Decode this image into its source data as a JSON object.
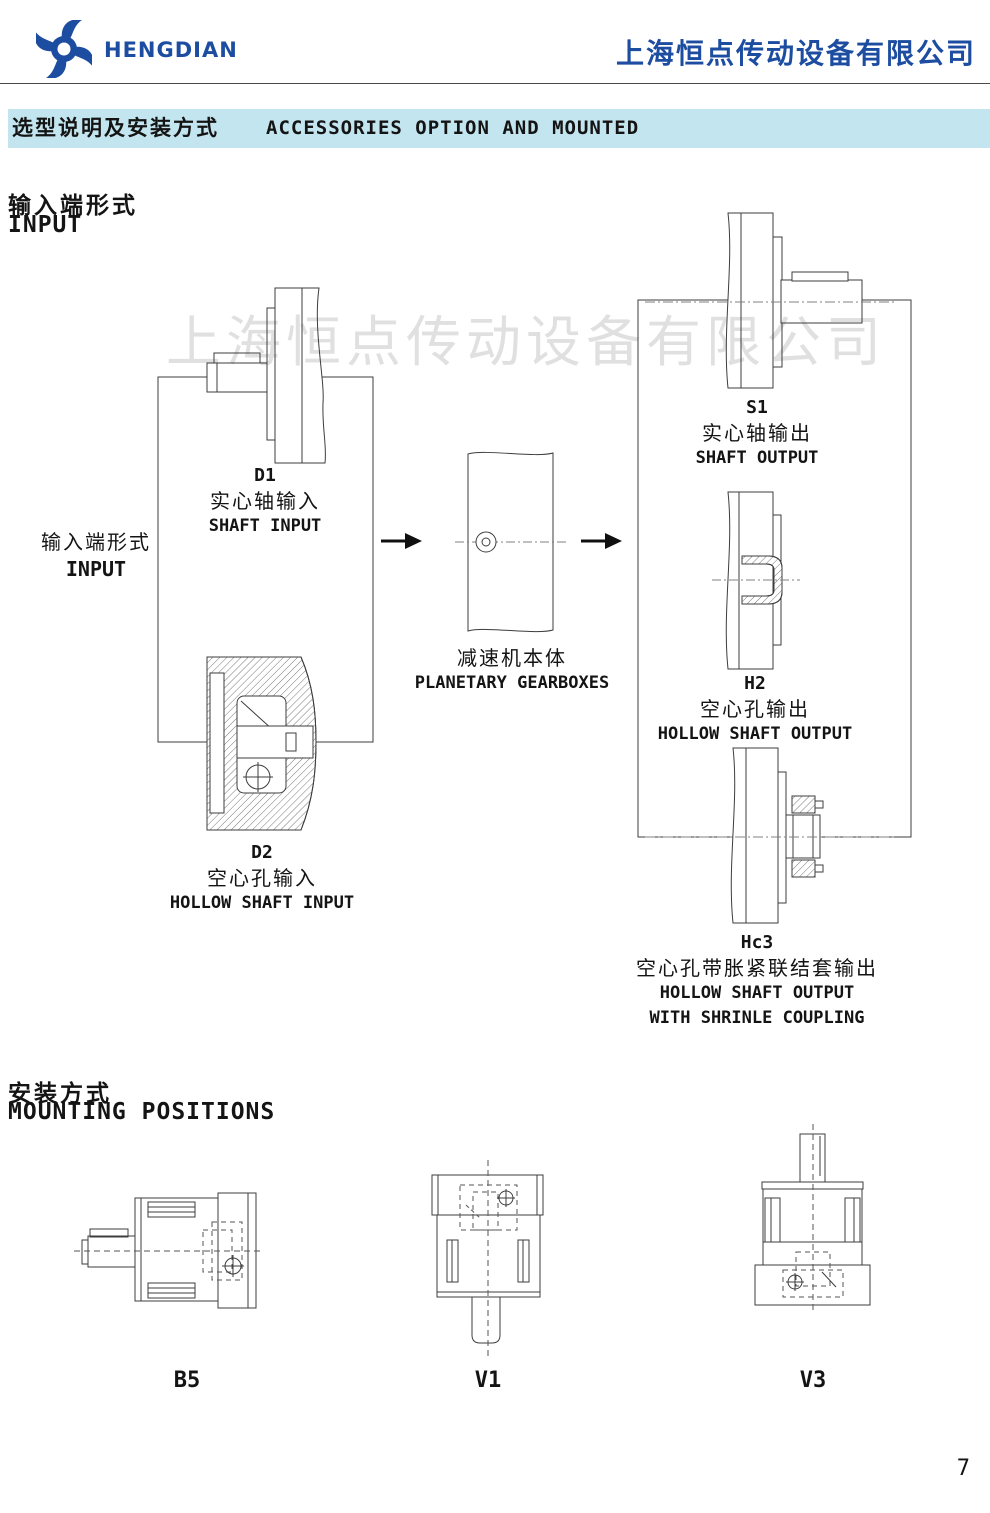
{
  "header": {
    "brand": "HENGDIAN",
    "company": "上海恒点传动设备有限公司"
  },
  "title_bar": {
    "zh": "选型说明及安装方式",
    "en": "ACCESSORIES OPTION AND MOUNTED"
  },
  "watermark": "上海恒点传动设备有限公司",
  "colors": {
    "brand_blue": "#1c4da0",
    "titlebar_bg": "#c3e5ef",
    "drawing_line": "#3d3d3d"
  },
  "input_section": {
    "heading_zh": "输入端形式",
    "heading_en": "INPUT",
    "side_zh": "输入端形式",
    "side_en": "INPUT",
    "d1": {
      "code": "D1",
      "zh": "实心轴输入",
      "en": "SHAFT INPUT"
    },
    "d2": {
      "code": "D2",
      "zh": "空心孔输入",
      "en": "HOLLOW SHAFT INPUT"
    },
    "gearbox": {
      "zh": "减速机本体",
      "en": "PLANETARY GEARBOXES"
    },
    "s1": {
      "code": "S1",
      "zh": "实心轴输出",
      "en": "SHAFT OUTPUT"
    },
    "h2": {
      "code": "H2",
      "zh": "空心孔输出",
      "en": "HOLLOW SHAFT OUTPUT"
    },
    "hc3": {
      "code": "Hc3",
      "zh": "空心孔带胀紧联结套输出",
      "en1": "HOLLOW SHAFT OUTPUT",
      "en2": "WITH SHRINLE COUPLING"
    }
  },
  "mounting_section": {
    "heading_zh": "安装方式",
    "heading_en": "MOUNTING POSITIONS",
    "b5": "B5",
    "v1": "V1",
    "v3": "V3"
  },
  "page": {
    "number": "7"
  }
}
